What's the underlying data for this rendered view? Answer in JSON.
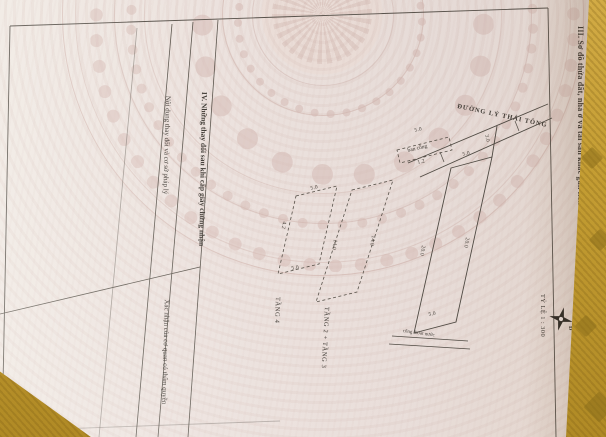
{
  "page": {
    "section3_title": "III. Sơ đồ thửa đất, nhà ở và tài sản khác gắn liền với đất",
    "scale_label": "TỶ LỆ 1 : 300",
    "compass_label": "Đ"
  },
  "diagram": {
    "street_name": "ĐƯỜNG LÝ THÁI TÔNG",
    "drain_label": "cống thoát nước",
    "balcony_label": "ban công",
    "floor2_label": "TẦNG 2 + TẦNG 3",
    "floor4_label": "TẦNG 4",
    "dims": {
      "front": "5.0",
      "setback": "3.0",
      "side_left": "20.0",
      "side_right": "20.0",
      "back": "5.0",
      "balcony_width": "5.0",
      "balcony_depth": "1.2",
      "f2_left": "14.0",
      "f2_right": "14.0",
      "f4_top": "5.0",
      "f4_left": "4.2",
      "f4_bottom": "5.0"
    }
  },
  "section4": {
    "title": "IV. Những thay đổi sau khi cấp giấy chứng nhận",
    "col1": "Nội dung thay đổi và cơ sở pháp lý",
    "col2": "Xác nhận của cơ quan có thẩm quyền"
  },
  "colors": {
    "paper": "#ece2de",
    "fabric": "#c49d33",
    "ink": "#3f3a34"
  }
}
